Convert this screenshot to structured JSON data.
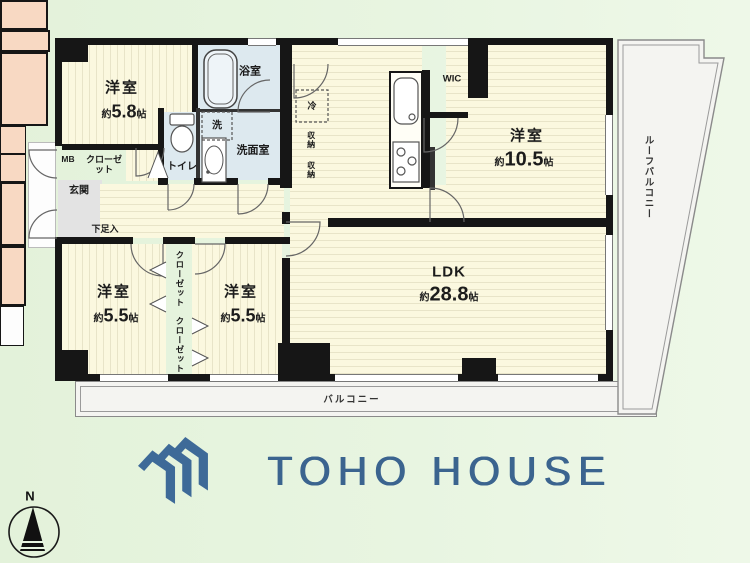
{
  "plan": {
    "rooms": {
      "bedroom_58": {
        "label": "洋室",
        "size_prefix": "約",
        "size_value": "5.8",
        "size_unit": "帖"
      },
      "bedroom_105": {
        "label": "洋室",
        "size_prefix": "約",
        "size_value": "10.5",
        "size_unit": "帖"
      },
      "bedroom_55_l": {
        "label": "洋室",
        "size_prefix": "約",
        "size_value": "5.5",
        "size_unit": "帖"
      },
      "bedroom_55_r": {
        "label": "洋室",
        "size_prefix": "約",
        "size_value": "5.5",
        "size_unit": "帖"
      },
      "ldk": {
        "label": "LDK",
        "size_prefix": "約",
        "size_value": "28.8",
        "size_unit": "帖"
      },
      "bath": "浴室",
      "washroom": "洗面室",
      "toilet": "トイレ",
      "laundry": "洗",
      "fridge": "冷",
      "storage_upper": "収納",
      "storage_lower": "収納",
      "wic": "WIC",
      "entrance": "玄関",
      "shoe_box": "下足入",
      "closet_entry": "クローゼット",
      "closet_upper": "クローゼット",
      "closet_lower": "クローゼット",
      "meter_box": "MB",
      "balcony": "バルコニー",
      "roof_balcony": "ルーフバルコニー"
    },
    "compass": {
      "north_label": "N"
    }
  },
  "branding": {
    "logo_text": "TOHO HOUSE"
  },
  "colors": {
    "logo_blue": "#3e6a98",
    "wall": "#161616",
    "room_cream": "#fbf8df",
    "wet_blue": "#dde9ef",
    "closet_pink": "#f8d9c3",
    "background_green": "#e6f4de"
  }
}
